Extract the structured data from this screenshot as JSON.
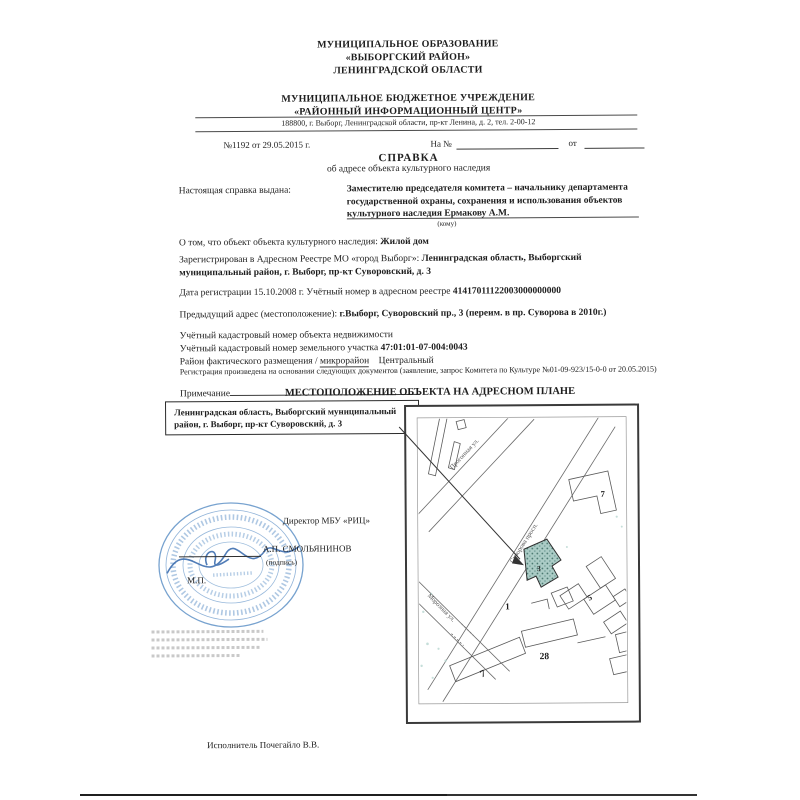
{
  "org_header": {
    "line1": "МУНИЦИПАЛЬНОЕ ОБРАЗОВАНИЕ",
    "line2": "«ВЫБОРГСКИЙ РАЙОН»",
    "line3": "ЛЕНИНГРАДСКОЙ ОБЛАСТИ",
    "institution_line1": "МУНИЦИПАЛЬНОЕ БЮДЖЕТНОЕ УЧРЕЖДЕНИЕ",
    "institution_line2": "«РАЙОННЫЙ ИНФОРМАЦИОННЫЙ ЦЕНТР»",
    "address": "188800, г. Выборг, Ленинградской области, пр-кт Ленина, д. 2, тел. 2-00-12"
  },
  "reference": {
    "number": "№1192 от 29.05.2015 г.",
    "incoming_label": "На №",
    "incoming_from_label": "от"
  },
  "title": {
    "main": "СПРАВКА",
    "subtitle": "об адресе объекта культурного наследия"
  },
  "issued": {
    "label": "Настоящая справка выдана:",
    "recipient": "Заместителю председателя комитета – начальнику департамента государственной охраны, сохранения и использования объектов культурного наследия Ермакову А.М.",
    "recipient_note": "(кому)"
  },
  "body": {
    "object_label": "О том, что объект объекта культурного наследия:",
    "object_value": "Жилой дом",
    "registered_label": "Зарегистрирован в Адресном Реестре МО «город Выборг»:",
    "registered_value": "Ленинградская область, Выборгский муниципальный район, г. Выборг, пр-кт Суворовский, д. 3",
    "registration_date_label": "Дата регистрации 15.10.2008 г. Учётный номер в адресном реестре",
    "registry_number": "41417011122003000000000",
    "previous_address_label": "Предыдущий адрес (местоположение):",
    "previous_address_value": "г.Выборг, Суворовский пр., 3 (переим. в пр. Суворова в 2010г.)",
    "cadastral_object_label": "Учётный кадастровый номер объекта недвижимости",
    "cadastral_parcel_label": "Учётный кадастровый номер земельного участка",
    "cadastral_parcel_value": "47:01:01-07-004:0043",
    "district_label": "Район фактического размещения /",
    "district_sublabel": "микрорайон",
    "district_value": "Центральный",
    "registration_basis": "Регистрация произведена на основании следующих документов (заявление, запрос Комитета по Культуре №01-09-923/15-0-0 от 20.05.2015)",
    "note_label": "Примечание"
  },
  "map_section": {
    "heading": "МЕСТОПОЛОЖЕНИЕ ОБЪЕКТА НА АДРЕСНОМ ПЛАНЕ",
    "callout_address": "Ленинградская область, Выборгский муниципальный район, г. Выборг, пр-кт Суворовский, д. 3",
    "streets": [
      {
        "name": "Прогонная ул."
      },
      {
        "name": "Суворова просп."
      },
      {
        "name": "Морозная ул."
      }
    ],
    "plot_numbers": [
      "7",
      "3",
      "1",
      "5",
      "28",
      "7"
    ],
    "building_fill": "#abccc6"
  },
  "signature": {
    "director_title": "Директор МБУ «РИЦ»",
    "director_name": "А.П. СМОЛЬЯНИНОВ",
    "sign_note": "(подпись)",
    "seal_note": "М.П.",
    "stamp_color": "#5f92c7"
  },
  "footer": {
    "executor": "Исполнитель Почегайло В.В."
  }
}
